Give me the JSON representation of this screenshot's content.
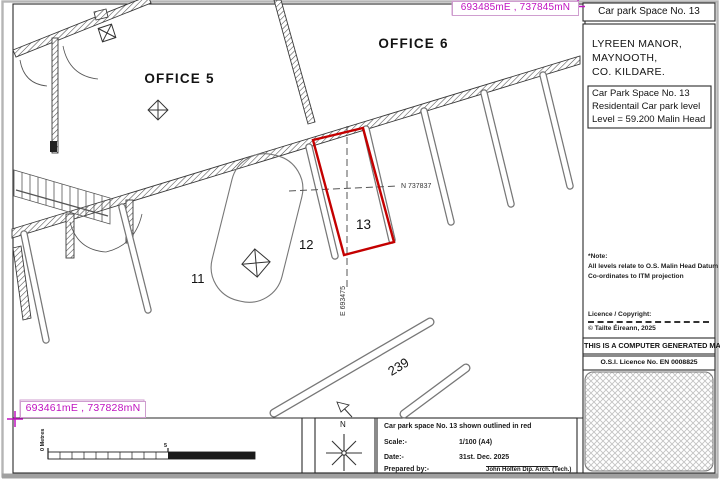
{
  "colors": {
    "red": "#c40000",
    "magenta": "#c012c0"
  },
  "title_block": {
    "title": "Car park Space No. 13",
    "address": [
      "LYREEN MANOR,",
      "MAYNOOTH,",
      "CO. KILDARE."
    ],
    "space_info": [
      "Car Park Space No. 13",
      "Residentail Car park level",
      "Level = 59.200 Malin Head"
    ],
    "notes": [
      "*Note:",
      "All levels relate to O.S. Malin Head Datum",
      "Co-ordinates to ITM projection"
    ],
    "licence_label": "Licence / Copyright:",
    "copyright": "© Tailte Éireann, 2025",
    "generated": "THIS IS A COMPUTER GENERATED MAP",
    "osi_licence": "O.S.I.  Licence No. EN 0008825"
  },
  "coordinates": {
    "top_right": "693485mE , 737845mN",
    "bottom_left": "693461mE , 737828mN",
    "north_line": "N 737837",
    "east_line": "E 693475"
  },
  "plan_labels": {
    "office5": "OFFICE 5",
    "office6": "OFFICE 6",
    "space11": "11",
    "space12": "12",
    "space13": "13",
    "space239": "239",
    "north": "N"
  },
  "scale_bar": {
    "zero_label": "0 Metres",
    "mid_label": "5"
  },
  "info_table": {
    "outline_note": "Car park space No. 13 shown outlined in red",
    "scale_label": "Scale:-",
    "scale_value": "1/100 (A4)",
    "date_label": "Date:-",
    "date_value": "31st. Dec. 2025",
    "prepared_label": "Prepared by:-",
    "prepared_by": "John Holten  Dip. Arch. (Tech.)"
  }
}
